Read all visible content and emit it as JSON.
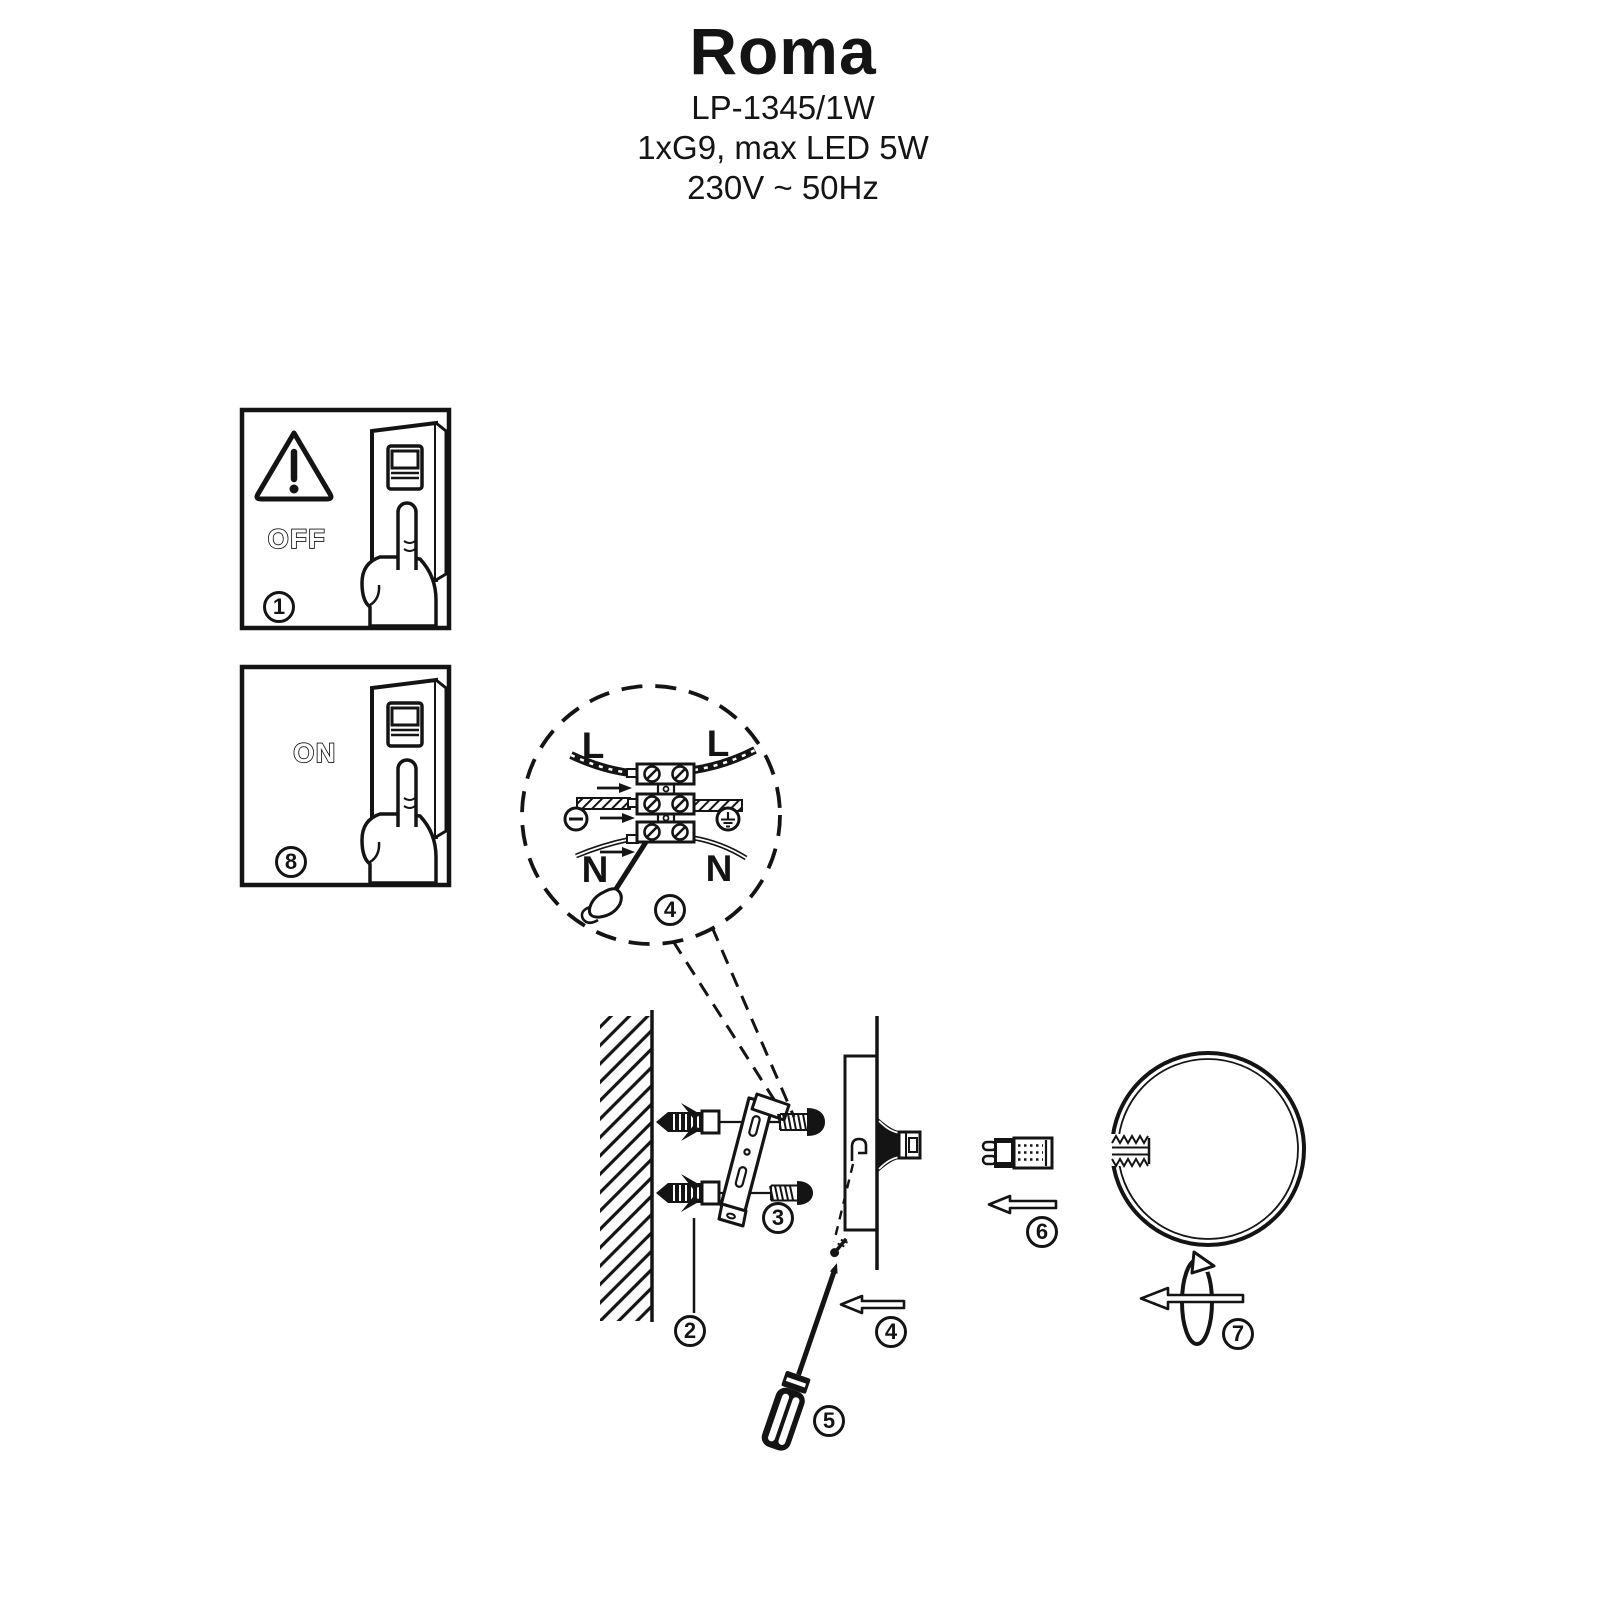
{
  "header": {
    "product_name": "Roma",
    "model": "LP-1345/1W",
    "lamp_spec": "1xG9, max LED 5W",
    "power_spec": "230V ~ 50Hz"
  },
  "step_panels": {
    "power_off": {
      "label": "OFF",
      "step_number": "1"
    },
    "power_on": {
      "label": "ON",
      "step_number": "8"
    }
  },
  "wiring_detail": {
    "step_number": "4",
    "labels": {
      "l_left": "L",
      "l_right": "L",
      "n_left": "N",
      "n_right": "N"
    }
  },
  "installation_steps": {
    "wall_anchor_step": "2",
    "bracket_step": "3",
    "screw_step": "4",
    "screwdriver_step": "5",
    "bulb_step": "6",
    "shade_step": "7"
  },
  "colors": {
    "ink": "#141414",
    "paper": "#ffffff"
  }
}
